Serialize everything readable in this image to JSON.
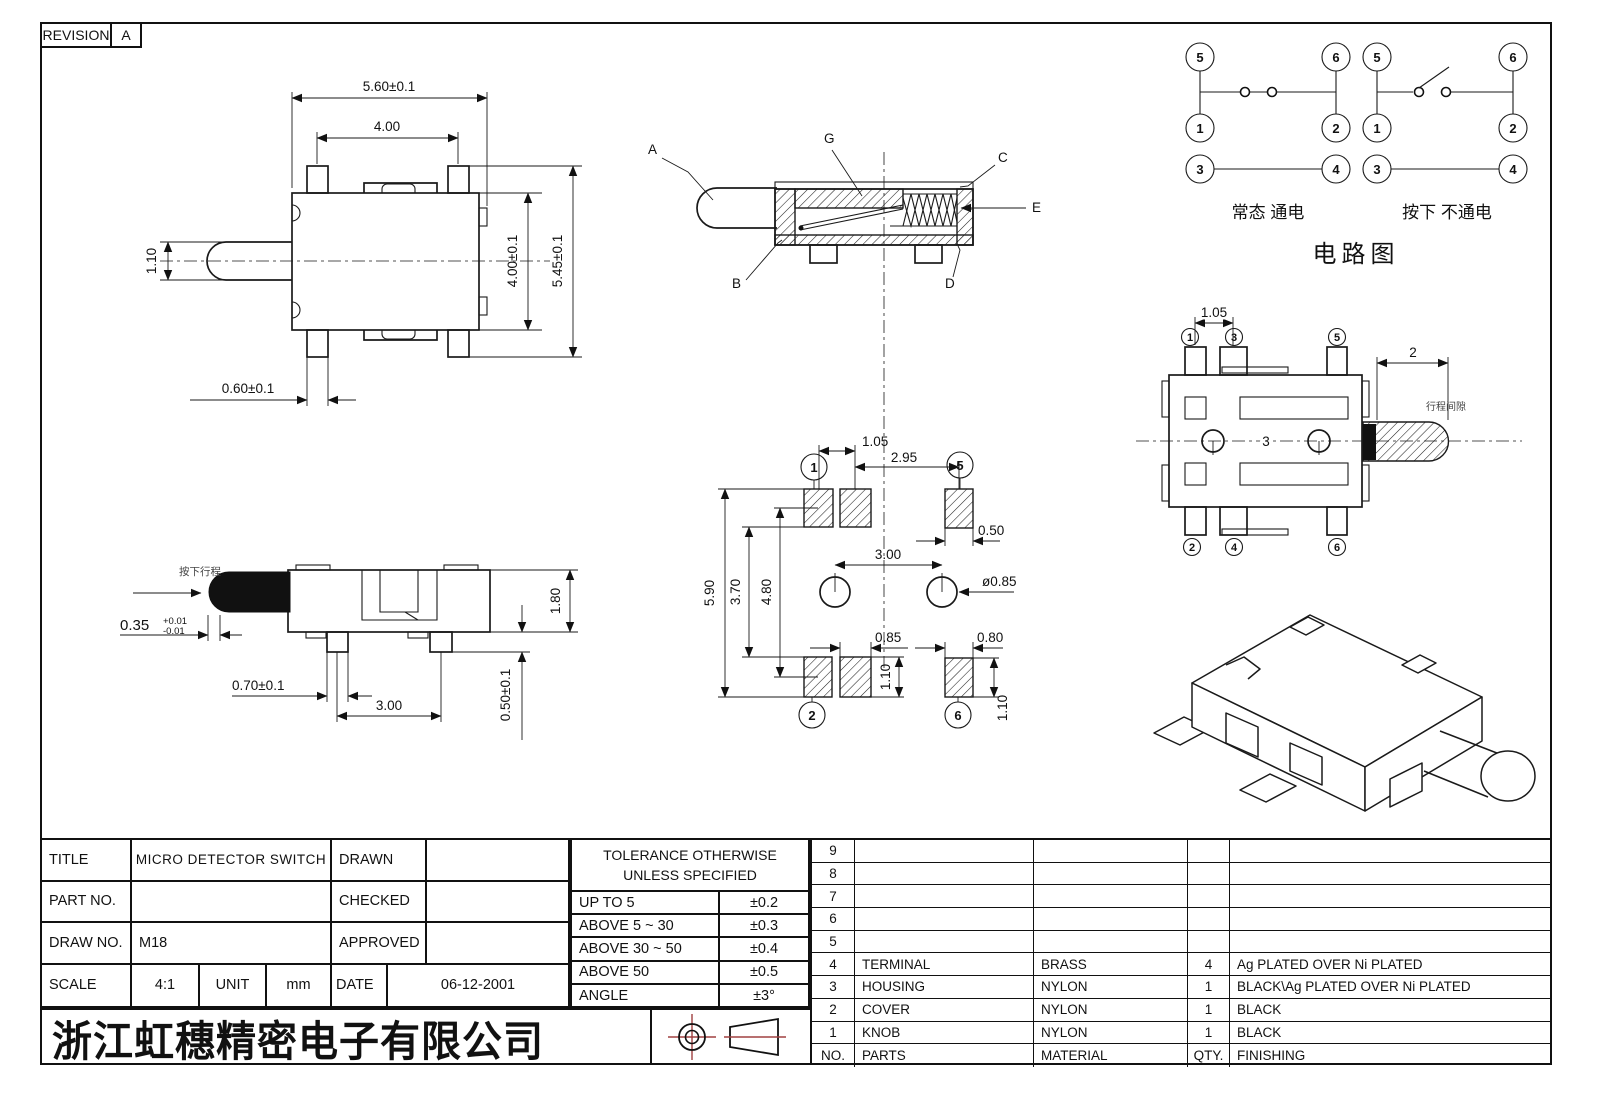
{
  "revision": {
    "label": "REVISION",
    "value": "A"
  },
  "top_view": {
    "dim_width_outer": "5.60±0.1",
    "dim_width_inner": "4.00",
    "dim_knob": "1.10",
    "dim_height_inner": "4.00±0.1",
    "dim_height_outer": "5.45±0.1",
    "dim_pin": "0.60±0.1"
  },
  "section_view": {
    "label_a": "A",
    "label_g": "G",
    "label_c": "C",
    "label_e": "E",
    "label_b": "B",
    "label_d": "D"
  },
  "circuit": {
    "left": {
      "pins": [
        "5",
        "6",
        "1",
        "2",
        "3",
        "4"
      ],
      "caption": "常态 通电"
    },
    "right": {
      "pins": [
        "5",
        "6",
        "1",
        "2",
        "3",
        "4"
      ],
      "caption": "按下 不通电"
    },
    "title": "电路图"
  },
  "pad_layout": {
    "pins": [
      "1",
      "5",
      "2",
      "6"
    ],
    "dim_pitch_small": "1.05",
    "dim_pitch_wide": "2.95",
    "dim_pad_w_top": "0.50",
    "dim_hole_pitch": "3.00",
    "dim_hole_dia": "ø0.85",
    "dim_height_outer": "5.90",
    "dim_height_inner": "3.70",
    "dim_height_mid": "4.80",
    "dim_pad_w_bottom": "0.85",
    "dim_pad_h_bottom": "1.10",
    "dim_pad_w_br": "0.80",
    "dim_pad_h_br": "1.10"
  },
  "bottom_view": {
    "pins_top": [
      "1",
      "3",
      "5"
    ],
    "pins_bottom": [
      "2",
      "4",
      "6"
    ],
    "dim_pin_pitch": "1.05",
    "dim_knob_len": "2",
    "dim_hole_pitch": "3",
    "note": "行程间隙"
  },
  "side_view": {
    "note": "按下行程",
    "dim_travel": "0.35",
    "dim_travel_plus": "+0.01",
    "dim_travel_minus": "-0.01",
    "dim_pin_w": "0.70±0.1",
    "dim_pin_pitch": "3.00",
    "dim_height": "1.80",
    "dim_standoff": "0.50±0.1"
  },
  "title_block": {
    "title_label": "TITLE",
    "title_value": "MICRO DETECTOR SWITCH",
    "part_no_label": "PART NO.",
    "part_no_value": "",
    "draw_no_label": "DRAW NO.",
    "draw_no_value": "M18",
    "drawn_label": "DRAWN",
    "drawn_value": "",
    "checked_label": "CHECKED",
    "checked_value": "",
    "approved_label": "APPROVED",
    "approved_value": "",
    "scale_label": "SCALE",
    "scale_value": "4:1",
    "unit_label": "UNIT",
    "unit_value": "mm",
    "date_label": "DATE",
    "date_value": "06-12-2001"
  },
  "tolerance_table": {
    "header_line1": "TOLERANCE OTHERWISE",
    "header_line2": "UNLESS SPECIFIED",
    "rows": [
      {
        "range": "UP TO 5",
        "tol": "±0.2"
      },
      {
        "range": "ABOVE 5 ~ 30",
        "tol": "±0.3"
      },
      {
        "range": "ABOVE 30 ~ 50",
        "tol": "±0.4"
      },
      {
        "range": "ABOVE 50",
        "tol": "±0.5"
      },
      {
        "range": "ANGLE",
        "tol": "±3°"
      }
    ]
  },
  "parts_table": {
    "rows": [
      {
        "no": "9",
        "part": "",
        "material": "",
        "qty": "",
        "finishing": ""
      },
      {
        "no": "8",
        "part": "",
        "material": "",
        "qty": "",
        "finishing": ""
      },
      {
        "no": "7",
        "part": "",
        "material": "",
        "qty": "",
        "finishing": ""
      },
      {
        "no": "6",
        "part": "",
        "material": "",
        "qty": "",
        "finishing": ""
      },
      {
        "no": "5",
        "part": "",
        "material": "",
        "qty": "",
        "finishing": ""
      },
      {
        "no": "4",
        "part": "TERMINAL",
        "material": "BRASS",
        "qty": "4",
        "finishing": "Ag PLATED OVER Ni PLATED"
      },
      {
        "no": "3",
        "part": "HOUSING",
        "material": "NYLON",
        "qty": "1",
        "finishing": "BLACK\\Ag PLATED OVER Ni PLATED"
      },
      {
        "no": "2",
        "part": "COVER",
        "material": "NYLON",
        "qty": "1",
        "finishing": "BLACK"
      },
      {
        "no": "1",
        "part": "KNOB",
        "material": "NYLON",
        "qty": "1",
        "finishing": "BLACK"
      }
    ],
    "footer": {
      "no": "NO.",
      "part": "PARTS",
      "material": "MATERIAL",
      "qty": "QTY.",
      "finishing": "FINISHING"
    }
  },
  "company": "浙江虹穗精密电子有限公司"
}
